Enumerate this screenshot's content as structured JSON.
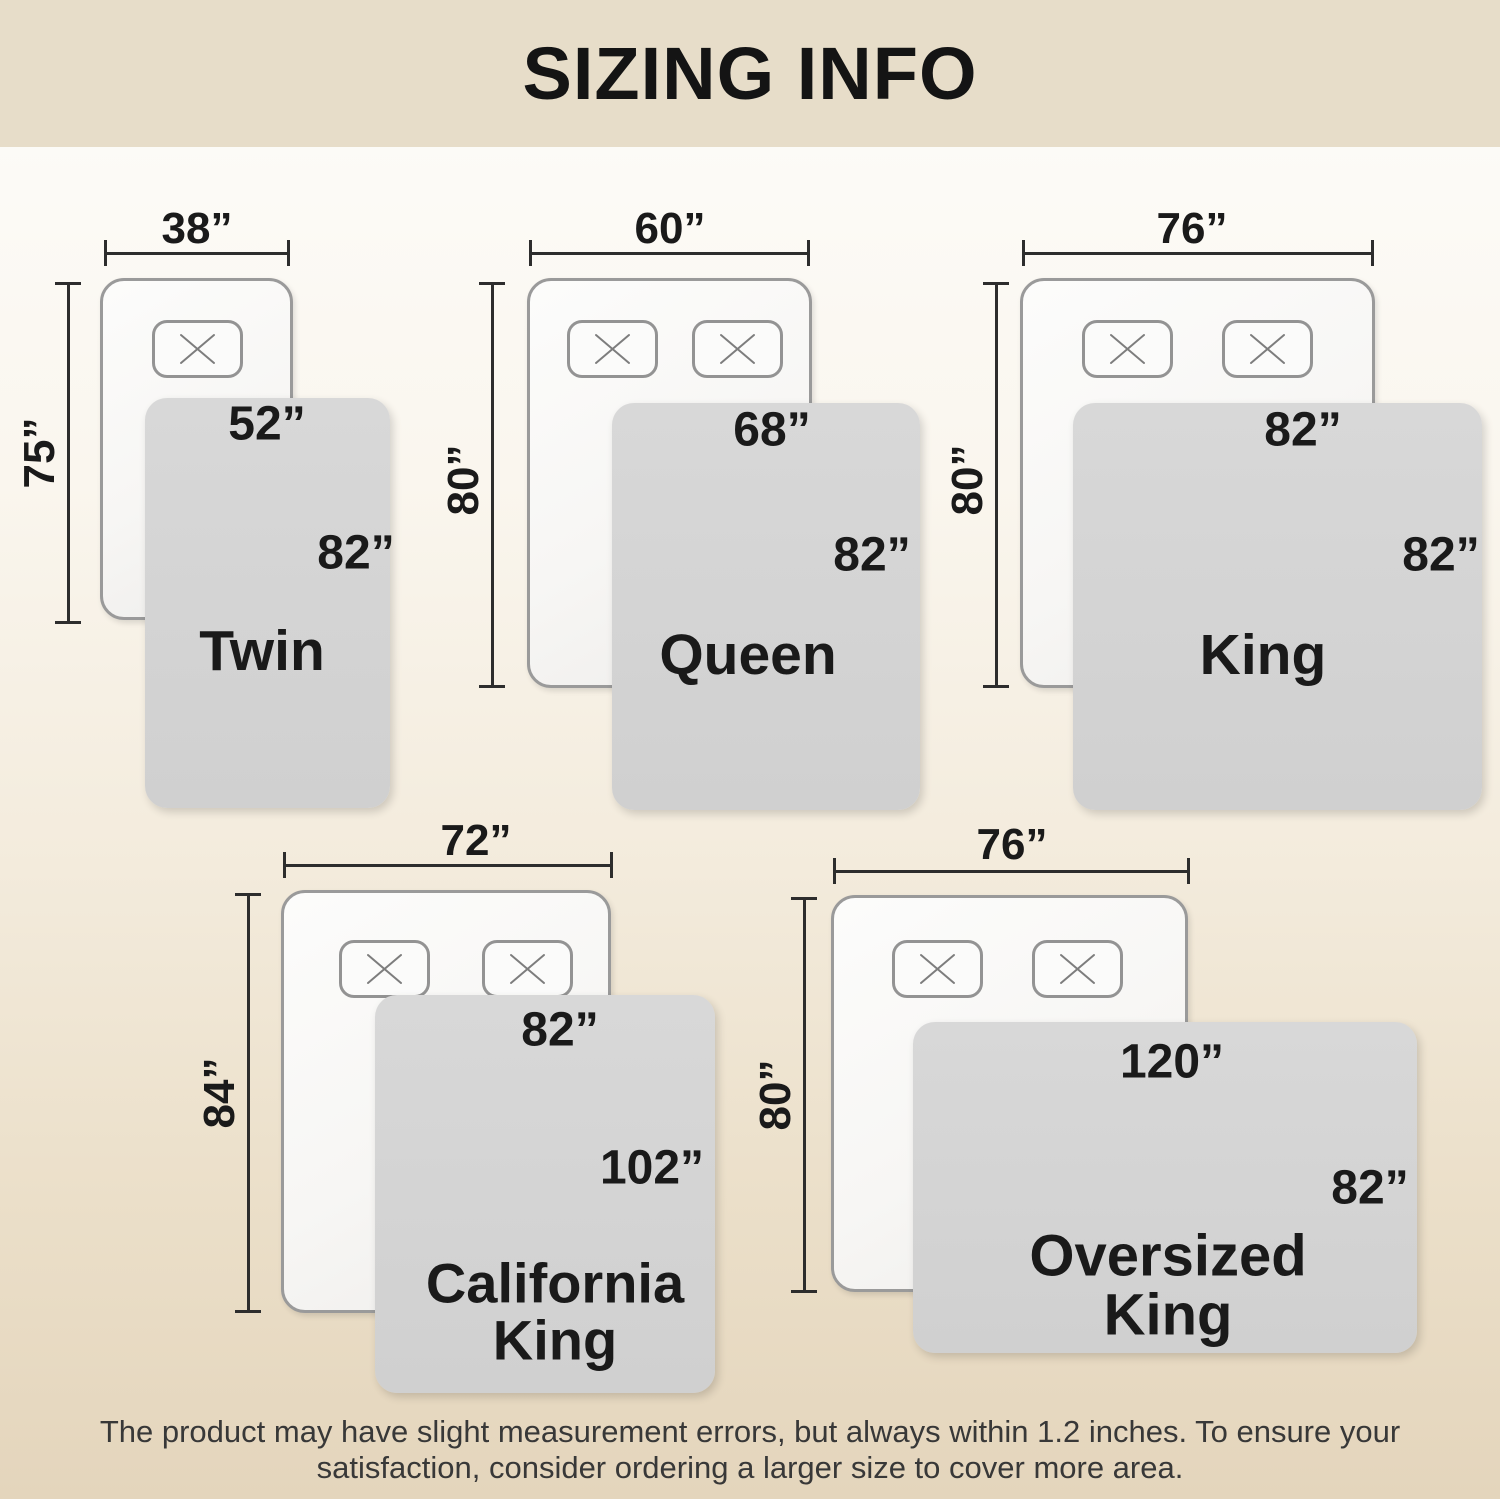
{
  "header": {
    "title": "SIZING INFO"
  },
  "diagrams": {
    "twin": {
      "name": "Twin",
      "bed_width": "38”",
      "bed_length": "75”",
      "blanket_width": "52”",
      "blanket_length": "82”"
    },
    "queen": {
      "name": "Queen",
      "bed_width": "60”",
      "bed_length": "80”",
      "blanket_width": "68”",
      "blanket_length": "82”"
    },
    "king": {
      "name": "King",
      "bed_width": "76”",
      "bed_length": "80”",
      "blanket_width": "82”",
      "blanket_length": "82”"
    },
    "california_king": {
      "name_line1": "California",
      "name_line2": "King",
      "bed_width": "72”",
      "bed_length": "84”",
      "blanket_width": "82”",
      "blanket_length": "102”"
    },
    "oversized_king": {
      "name_line1": "Oversized",
      "name_line2": "King",
      "bed_width": "76”",
      "bed_length": "80”",
      "blanket_width": "120”",
      "blanket_length": "82”"
    }
  },
  "footer": {
    "line1": "The product may have slight measurement errors, but always within 1.2 inches. To ensure your",
    "line2": "satisfaction, consider ordering a larger size to cover more area."
  },
  "icons": {
    "pillow": "x-icon"
  },
  "colors": {
    "header_bg": "#e7ddc9",
    "background_top": "#fdfdfb",
    "background_bottom": "#e4d5bc",
    "blanket": "#d4d4d4",
    "bed_fill": "#f8f7f5",
    "bed_border": "#9a9a9a",
    "dimension_line": "#2d2d2d",
    "label_text": "#1a1a1a",
    "footer_text": "#383838"
  }
}
